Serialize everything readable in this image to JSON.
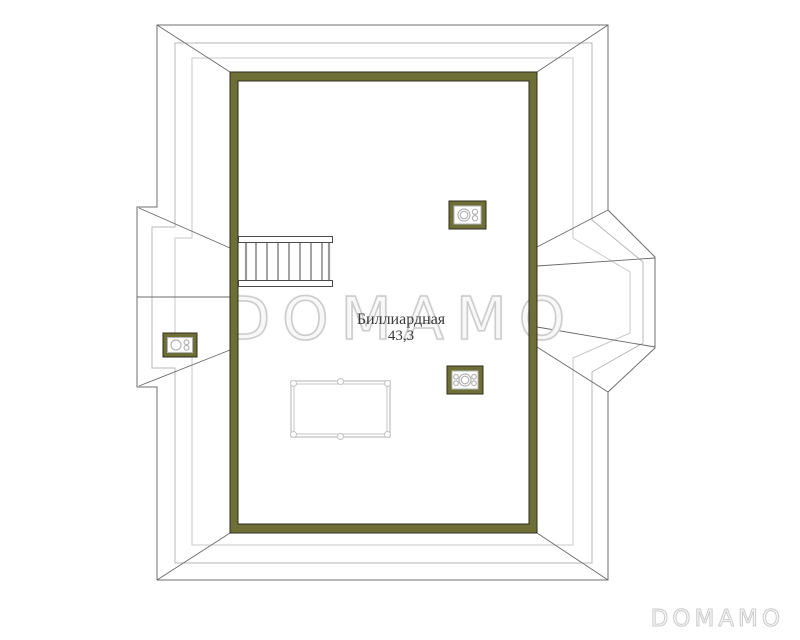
{
  "room": {
    "label": "Биллиардная",
    "area": "43,3"
  },
  "watermark": {
    "center": "DOMAMO",
    "corner": "DOMAMO"
  },
  "plan": {
    "type": "attic floor plan",
    "fixtures": [
      "staircase",
      "billiard-table",
      "roof-window-left",
      "roof-window-top",
      "roof-window-bottom"
    ],
    "dormers": [
      "left-gable-dormer",
      "right-hip-dormer"
    ]
  },
  "colors": {
    "wall": "#6e6e37",
    "wall_outline": "#2e2e1c",
    "roof_dark": "#6f6f6f",
    "roof_mid": "#b8b8b8",
    "roof_light": "#c9c9c9",
    "hip_line": "#6a6a6a",
    "fixture_symbol": "#b4b4b4",
    "table_line": "#c4c4c4",
    "stair_line": "#4a4a4a",
    "stair_rail": "#999999",
    "label_text": "#3a3a3a",
    "watermark_stroke": "#cdcdcd",
    "watermark_fill": "#f8f8f8"
  }
}
